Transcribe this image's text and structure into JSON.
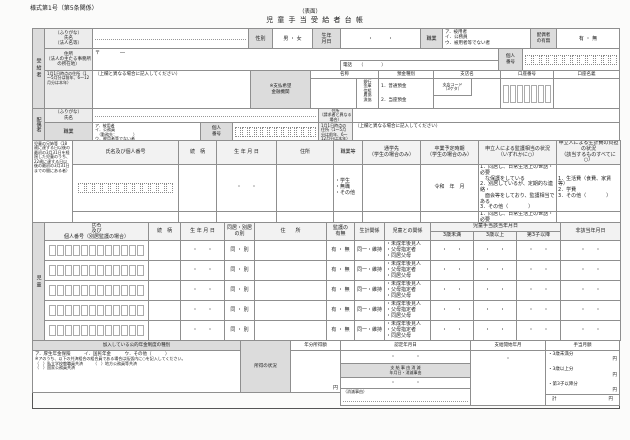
{
  "page": {
    "form_no": "様式第1号（第5条関係）",
    "side": "（表面）",
    "title": "児 童 手 当 受 給 者 台 帳"
  },
  "recipient": {
    "section": "受給者",
    "name_label": "（ふりがな）\n氏名\n（法人名等）",
    "sex_label": "性別",
    "sex_value": "男 ・ 女",
    "birth_label": "生年\n月日",
    "birth_value": "・　　　・",
    "job_label": "職業",
    "job_options": [
      "ア．被用者",
      "イ．公務員",
      "ウ．被用者等でない者"
    ],
    "spouse_label": "配偶者\nの有無",
    "spouse_value": "有 ・ 無",
    "address_label": "住所\n（法人の主たる事務所の所在地）",
    "postal": "〒　　　　―",
    "phone": "電話　　（　　　　）",
    "mynumber_label": "個人\n番号",
    "jan1_label": "1月1日時点の住所（1～5月分は前年、6～12月分は本年）",
    "jan1_note": "（上欄と異なる場合に記入してください）"
  },
  "bank": {
    "label": "※支払希望\n金融機関",
    "name_header": "名称",
    "bank_types": [
      "銀行",
      "金庫",
      "信組",
      "農協",
      "漁協"
    ],
    "deposit_header": "預金種別",
    "deposit_options": [
      "1．普通預金",
      "2．当座預金"
    ],
    "branch_header": "支店名",
    "branch_code": "支店コード\n（3ケタ）",
    "account_header": "口座番号",
    "holder_header": "口座名義"
  },
  "spouse": {
    "section": "配偶者",
    "name_label": "（ふりがな）\n氏名",
    "job_label": "職業",
    "job_options": [
      "ア．被用者",
      "イ．公務員",
      "　（勤務先：　　　　）",
      "ウ．被用者等でない者"
    ],
    "mynumber_label": "個人\n番号",
    "address_label": "住所\n（請求者と異なる場合）",
    "jan1_label": "1月1日時点の住所（1～5月分は前年、6～12月分は本年）",
    "jan1_note": "（上欄と異なる場合に記入してください）"
  },
  "siblings": {
    "section": "児童の兄姉等（18歳に達する日以後の最初の3月31日を経過した児童のうち、22歳に達する日以後の最初の3月31日までの間にある者）",
    "headers": {
      "name": "氏名及び個人番号",
      "relation": "続　柄",
      "birth": "生 年 月 日",
      "address": "住所",
      "occupation": "職業等",
      "school": "通学先\n（学生の場合のみ）",
      "graduation": "卒業予定時期\n（学生の場合のみ）",
      "care": "申立人による監護相当の状況\n（いずれかに○）",
      "support": "申立人による生計費の負担の状況\n（該当するものすべてに○）"
    },
    "row": {
      "occupation": "・学生\n・無職\n・その他",
      "birth": "・　　・",
      "graduation": "令和　年　月",
      "care": "1．同居し、日常生活上の世話・必要\n　な保護をしている\n2．別居しているが、定期的な連絡・\n　面会等をしており、監護相当である\n3．その他（　　　　）",
      "support": "1．生活費（食費、家賃等）\n2．学費\n3．その他（　　　　）"
    }
  },
  "children": {
    "section": "児童",
    "headers": {
      "name": "氏名\n及び\n個人番号（別居監護の場合）",
      "relation": "続　柄",
      "birth": "生 年 月 日",
      "living": "同居・別居\nの別",
      "address": "住　　所",
      "custody": "監護の\n有無",
      "livelihood": "生計関係",
      "relation_to": "児童との関係",
      "eligible_group": "児童手当該当年月日",
      "under3": "3歳未満",
      "over3": "3歳以上",
      "third": "第3子以降",
      "ineligible": "非該当年月日"
    },
    "row": {
      "birth": "・　　・",
      "living": "同 ・ 別",
      "custody": "有 ・ 無",
      "livelihood": "同一・維持",
      "relation_to": "・未成年後見人\n・父母指定者\n・同居父母",
      "date": "・　　・"
    }
  },
  "pension": {
    "header": "加入している公的年金制度の種別",
    "line1": "ア．厚生年金保険　　　イ．国民年金　　　ウ．その他（　　　）",
    "note": "※アのうち、以下の共済組合の組合員である場合は括弧内に○を記入してください。",
    "opts": "（　）私立学校教職員共済　　　（　）地方公務員等共済\n（　）国家公務員共済",
    "income_label": "所得の状況",
    "amount_header": "年分所得額",
    "yen": "円"
  },
  "office": {
    "nintei_header": "認定年月日",
    "nintei_value": "・　　　　・",
    "extinct_header": "支 給 事 由 消 滅\n年月日・消滅事由",
    "extinct_value": "・　　　　・",
    "extinct_note": "（消滅事由）",
    "start_header": "支給開始年月",
    "start_value": "・",
    "monthly_header": "手当月額",
    "m1": "・3歳未満分",
    "m2": "・3歳以上分",
    "m3": "・第3子以降分",
    "yen": "円",
    "total": "計"
  }
}
